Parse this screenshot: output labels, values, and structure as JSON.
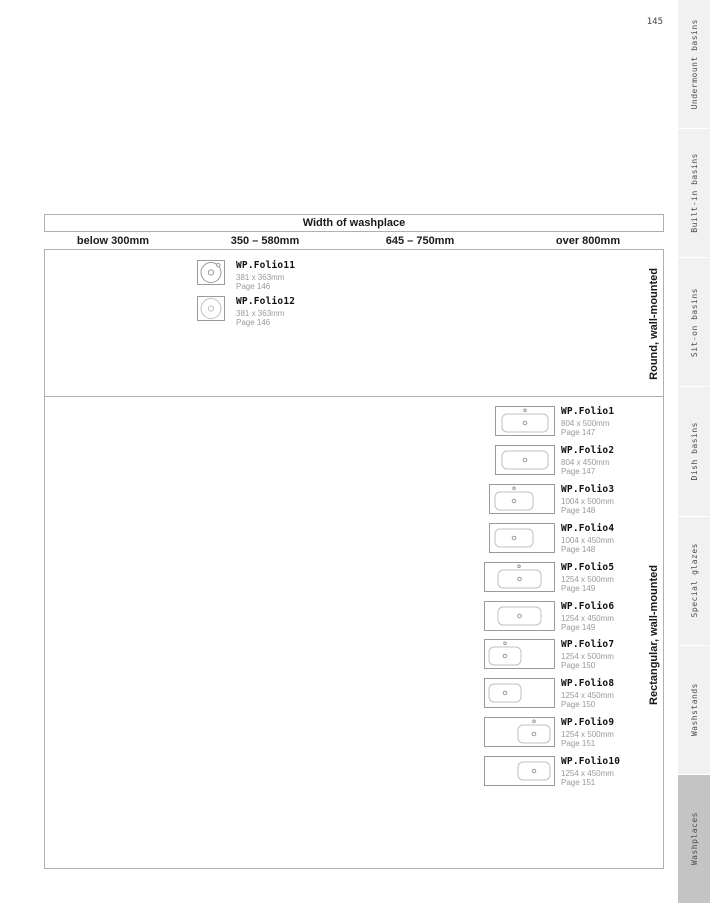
{
  "page": {
    "number": "145"
  },
  "table": {
    "title": "Width of washplace",
    "columns": [
      "below 300mm",
      "350 – 580mm",
      "645 – 750mm",
      "over 800mm"
    ],
    "sections": [
      {
        "label": "Round, wall-mounted",
        "products": [
          {
            "name": "WP.Folio11",
            "size": "381 x 363mm",
            "page": "Page 146",
            "icon": "round-basin-with-tap-icon",
            "spec": {
              "shape": "round",
              "tap": true,
              "light": false
            }
          },
          {
            "name": "WP.Folio12",
            "size": "381 x 363mm",
            "page": "Page 146",
            "icon": "round-basin-icon",
            "spec": {
              "shape": "round",
              "tap": false,
              "light": true
            }
          }
        ]
      },
      {
        "label": "Rectangular, wall-mounted",
        "products": [
          {
            "name": "WP.Folio1",
            "size": "804 x 500mm",
            "page": "Page 147",
            "icon": "rect-basin-center-tap-icon",
            "spec": {
              "shape": "rect",
              "w": 60,
              "basin": [
                7,
                53
              ],
              "tap": true,
              "tapX": 30
            }
          },
          {
            "name": "WP.Folio2",
            "size": "804 x 450mm",
            "page": "Page 147",
            "icon": "rect-basin-center-icon",
            "spec": {
              "shape": "rect",
              "w": 60,
              "basin": [
                7,
                53
              ],
              "tap": false
            }
          },
          {
            "name": "WP.Folio3",
            "size": "1004 x 500mm",
            "page": "Page 148",
            "icon": "rect-basin-left-tap-icon",
            "spec": {
              "shape": "rect",
              "w": 66,
              "basin": [
                6,
                44
              ],
              "tap": true,
              "tapX": 25
            }
          },
          {
            "name": "WP.Folio4",
            "size": "1004 x 450mm",
            "page": "Page 148",
            "icon": "rect-basin-left-icon",
            "spec": {
              "shape": "rect",
              "w": 66,
              "basin": [
                6,
                44
              ],
              "tap": false
            }
          },
          {
            "name": "WP.Folio5",
            "size": "1254 x 500mm",
            "page": "Page 149",
            "icon": "wide-basin-center-tap-icon",
            "spec": {
              "shape": "rect",
              "w": 71,
              "basin": [
                14,
                57
              ],
              "tap": true,
              "tapX": 35
            }
          },
          {
            "name": "WP.Folio6",
            "size": "1254 x 450mm",
            "page": "Page 149",
            "icon": "wide-basin-center-icon",
            "spec": {
              "shape": "rect",
              "w": 71,
              "basin": [
                14,
                57
              ],
              "tap": false
            }
          },
          {
            "name": "WP.Folio7",
            "size": "1254 x 500mm",
            "page": "Page 150",
            "icon": "wide-basin-left-tap-icon",
            "spec": {
              "shape": "rect",
              "w": 71,
              "basin": [
                5,
                37
              ],
              "tap": true,
              "tapX": 21
            }
          },
          {
            "name": "WP.Folio8",
            "size": "1254 x 450mm",
            "page": "Page 150",
            "icon": "wide-basin-left-icon",
            "spec": {
              "shape": "rect",
              "w": 71,
              "basin": [
                5,
                37
              ],
              "tap": false
            }
          },
          {
            "name": "WP.Folio9",
            "size": "1254 x 500mm",
            "page": "Page 151",
            "icon": "wide-basin-right-tap-icon",
            "spec": {
              "shape": "rect",
              "w": 71,
              "basin": [
                34,
                66
              ],
              "tap": true,
              "tapX": 50
            }
          },
          {
            "name": "WP.Folio10",
            "size": "1254 x 450mm",
            "page": "Page 151",
            "icon": "wide-basin-right-icon",
            "spec": {
              "shape": "rect",
              "w": 71,
              "basin": [
                34,
                66
              ],
              "tap": false
            }
          }
        ]
      }
    ]
  },
  "sidebar": {
    "tabs": [
      {
        "label": "Undermount basins",
        "active": false
      },
      {
        "label": "Built-in basins",
        "active": false
      },
      {
        "label": "Sit-on basins",
        "active": false
      },
      {
        "label": "Dish basins",
        "active": false
      },
      {
        "label": "Special glazes",
        "active": false
      },
      {
        "label": "Washstands",
        "active": false
      },
      {
        "label": "Washplaces",
        "active": true
      }
    ]
  },
  "colors": {
    "tab_inactive": "#f1f1f1",
    "tab_active": "#c4c4c4",
    "border": "#b0b0b0",
    "icon_stroke": "#9a9a9a",
    "icon_stroke_light": "#c0c0c0",
    "muted_text": "#9a9a9a"
  }
}
